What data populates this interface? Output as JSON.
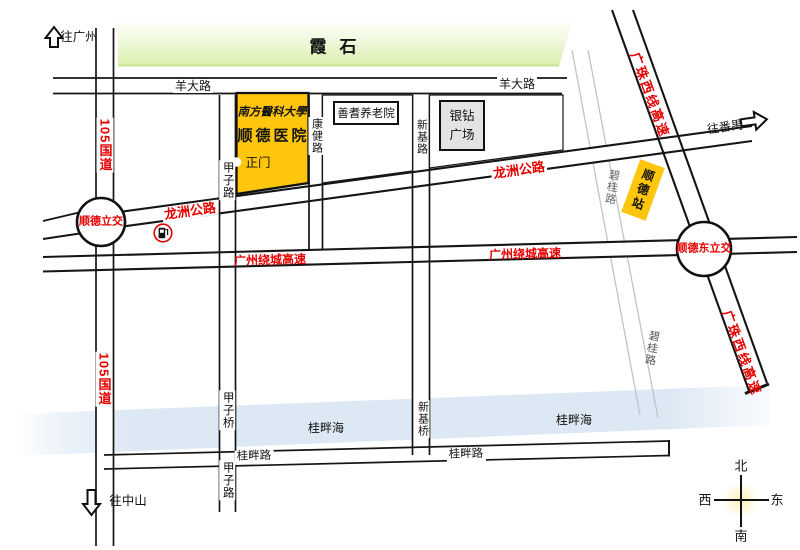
{
  "banner": {
    "label": "霞石"
  },
  "directions": {
    "to_guangzhou": "往广州",
    "to_zhongshan": "往中山",
    "to_panyu": "往番禺"
  },
  "roads": {
    "g105": "105国道",
    "yangda": "羊大路",
    "jiazi_road": "甲子路",
    "jiazi_bridge": "甲子桥",
    "kangjian": "康健路",
    "xinji_road": "新基路",
    "xinji_bridge": "新基桥",
    "longzhou": "龙洲公路",
    "gz_ring": "广州绕城高速",
    "gz_west_line": "广珠西线高速",
    "bigui": "碧桂路",
    "guipan_road": "桂畔路"
  },
  "water": {
    "guipan_sea": "桂畔海"
  },
  "junctions": {
    "shunde": "顺德立交",
    "shunde_east": "顺德东立交"
  },
  "places": {
    "hospital": {
      "university": "南方醫科大學",
      "name": "顺德医院",
      "gate": "正门"
    },
    "nursing_home": {
      "name": "善耆养老院"
    },
    "yinzuan_plaza": {
      "name": "银钻广场"
    },
    "shunde_station": {
      "name": "顺德站"
    }
  },
  "icons": {
    "gas_station": "fuel-pump-icon"
  },
  "compass": {
    "north": "北",
    "south": "南",
    "west": "西",
    "east": "东"
  },
  "colors": {
    "highlight_yellow": "#FFC60D",
    "label_red": "#E60000",
    "water_blue": "#DCE8F4",
    "banner_green": "#D9EFAD"
  }
}
